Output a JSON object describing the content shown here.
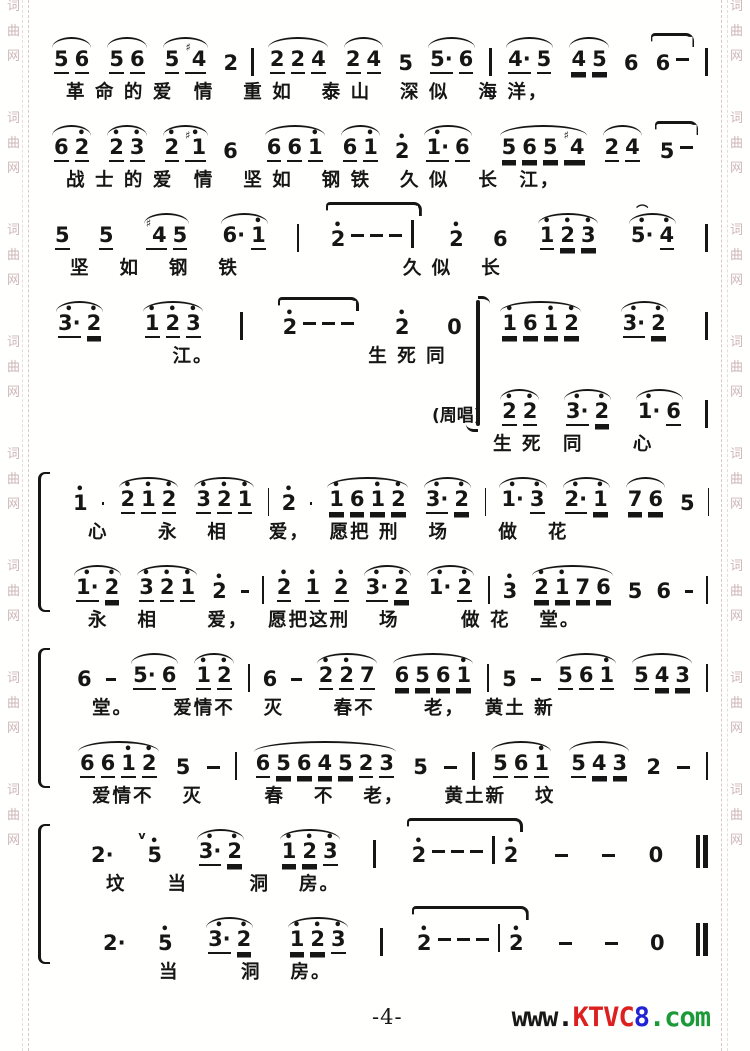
{
  "page": {
    "footer": {
      "page_number": "-4-"
    },
    "site": {
      "www": "www.",
      "name": "KTVC",
      "num": "8",
      "tld": ".com",
      "color_www": "#181818",
      "color_name": "#dd1f1f",
      "color_num": "#2323d6",
      "color_tld": "#1c9a3a"
    },
    "watermark": {
      "chars": [
        "词",
        "曲",
        "网"
      ],
      "color": "#cdb7b7",
      "groups": 8
    },
    "ink_color": "#161616"
  },
  "systems": [
    {
      "label": "",
      "indent": 4,
      "notes": "[ 5_ 6_ ] [ 5_ 6_ ] [ 5_ #4_ ] 2 | [ 2_ 2_ 4_ ] [ 2_ 4_ ] 5 [ 5_. 6_ ] | [ 4_. 5_ ] [ 4= 5= ] 6 { 6 - } |",
      "lyrics": "革 命 的 爱　情　 重 如　 泰 山　 深 似　 海 洋，"
    },
    {
      "label": "",
      "indent": 4,
      "notes": "[ 6_ 2'_ ] [ 2'_ 3'_ ] [ 2'_ #1'_ ] 6 | [ 6_ 6_ 1'_ ] [ 6_ 1'_ ] 2' [ 1'_. 6_ ] | [ 5= 6= 5= #4= ] [ 2_ 4_ ] { 5 - } |",
      "lyrics": "战 士 的 爱　情　 坚 如　 钢 铁　 久 似　 长　江，"
    },
    {
      "label": "",
      "indent": 8,
      "notes": "5_ 5_ [ #4_ 5_ ] [ 6. 1'_ ] | { 2' - - - | } 2' 6 [ 1'_ 2'= 3'= ] [ 5'.^ 4'_ ] |",
      "lyrics": "坚　 如　 钢　 铁　　　　　　　　久 似　 长"
    },
    {
      "label": "",
      "indent": 8,
      "mid_brace": true,
      "notes": "[ 3'_. 2'= ] [ 1'_ 2'_ 3'_ ] | { 2' - - - } 2' 0 [ 1'= 6= 1'= 2'= ] [ 3'_. 2'= ] |",
      "lyrics": "　　　　　江。　　　　　　　　生 死 同"
    },
    {
      "label": "(周唱)",
      "indent": 392,
      "notes": "[ 2'_ 2'_ ] [ 3'_. 2'= ] [ 1'. 6_ ] |",
      "lyrics": "　　生 死　同　　 心"
    },
    {
      "label": "",
      "indent": 26,
      "notes": "1' - [ 2'_ 1'_ 2'_ ] [ 3'_ 2'_ 1'_ ] | 2' - [ 1'= 6= 1'= 2'= ] [ 3'_. 2'= ] | [ 1'. 3'_ ] [ 2'_. 1'= ] [ 7= 6= ] 5 |",
      "lyrics": "心　　 永　 相　　爱，　 愿把 刑　 场　　 做　 花"
    },
    {
      "label": "",
      "indent": 26,
      "notes": "[ 1'_. 2'= ] [ 3'_ 2'_ 1'_ ] 2' - | 2'_ 1'_ 2'_ [ 3'_. 2'= ] [ 1'. 2'_ ] | 3' [ 2'= 1'= 7= 6= ] 5 6 - |",
      "lyrics": "永　 相　　 爱，　 愿把这刑　 场　　　做 花　 堂。"
    },
    {
      "label": "",
      "indent": 30,
      "notes": "6 - [ 5_. 6_ ] [ 1'_ 2'_ ] | 6 - [ 2'_ 2'_ 7_ ] [ 6= 5= 6= 1'= ] | 5 - [ 5_ 6_ 1'_ ] [ 5_ 4= 3= ] |",
      "lyrics": "堂。　　 爱情不　 灭　　 春不　　 老，　 黄土 新"
    },
    {
      "label": "",
      "indent": 30,
      "notes": "[ 6_ 6_ 1'_ 2'_ ] 5 - | [ 6_ 5= 6= 4= 5= 2_ 3_ ] 5 - | [ 5_ 6_ 1'_ ] [ 5_ 4= 3= ] 2 - |",
      "lyrics": "爱情不　 灭　　　春　 不　 老，　　 黄土新　 坟"
    },
    {
      "label": "",
      "indent": 44,
      "notes": "2. v5' [ 3'_. 2'= ] [ 1'= 2'= 3'_ ] | { 2' - - - | 2' } - - 0 ||",
      "lyrics": "坟　　当　　　洞　 房。"
    },
    {
      "label": "",
      "indent": 56,
      "notes": "2. 5' [ 3'_. 2'= ] [ 1'= 2'= 3'_ ] | { 2' - - - | 2' } - - 0 ||",
      "lyrics": "　　当　　　洞　 房。"
    }
  ],
  "bracket_pairs": [
    [
      5,
      6
    ],
    [
      7,
      8
    ],
    [
      9,
      10
    ]
  ]
}
